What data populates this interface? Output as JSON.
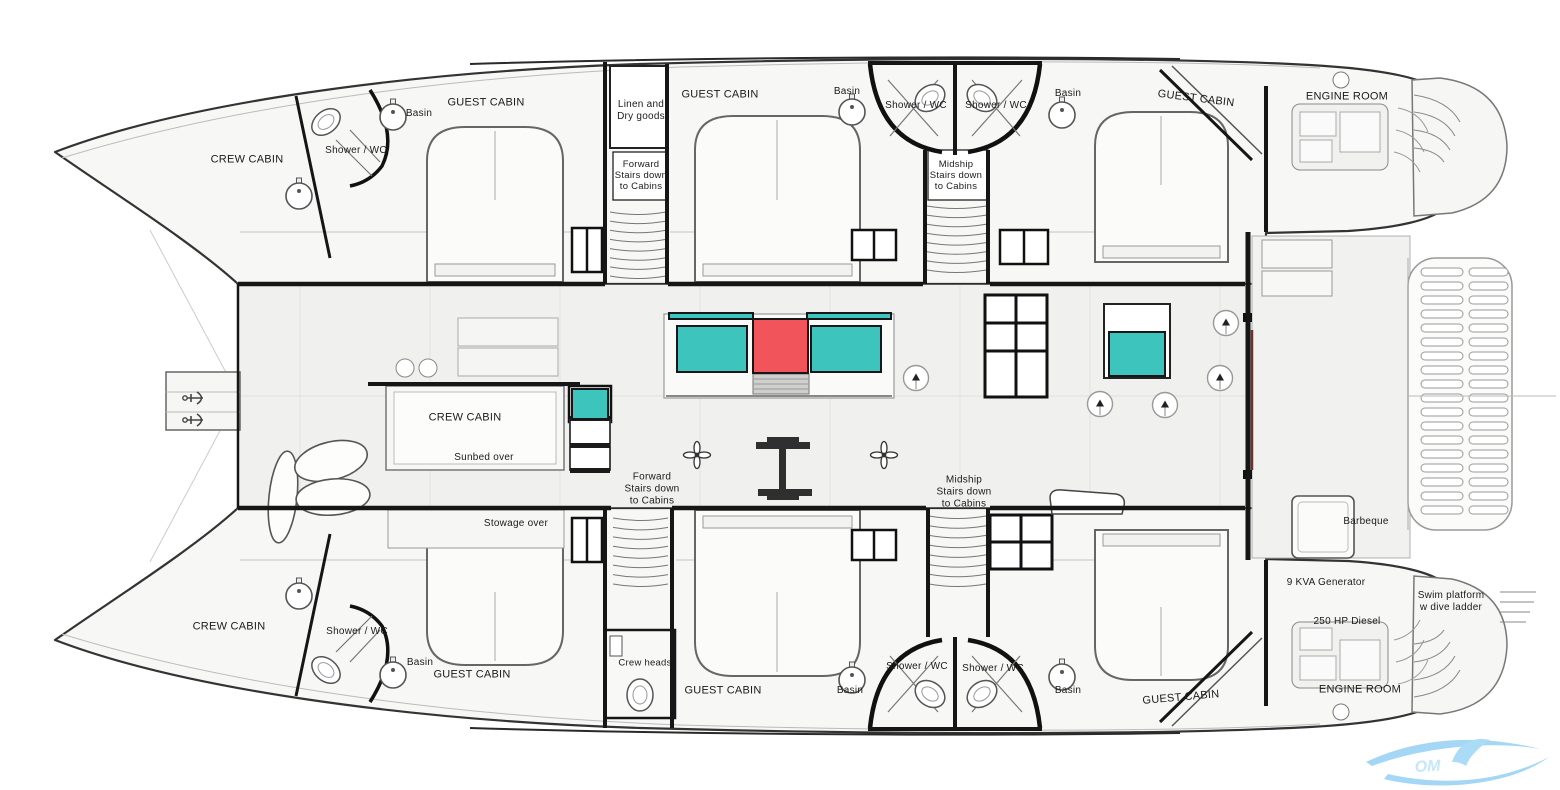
{
  "title": "Catamaran yacht deck floor plan",
  "colors": {
    "teal": "#3cc4bd",
    "red": "#f2545b",
    "wall": "#1b1b1b",
    "watermark_blue": "#9ad2f4",
    "watermark_text": "#c6e6fa",
    "label_color": "#1b1b1b"
  },
  "labels": [
    {
      "id": "crew-cabin-top-left",
      "text": "CREW CABIN",
      "x": 247,
      "y": 160,
      "size": 11
    },
    {
      "id": "shower-wc-top-left",
      "text": "Shower / WC",
      "x": 356,
      "y": 151,
      "size": 10
    },
    {
      "id": "basin-top-left",
      "text": "Basin",
      "x": 419,
      "y": 114,
      "size": 10
    },
    {
      "id": "guest-cabin-top-left",
      "text": "GUEST CABIN",
      "x": 486,
      "y": 103,
      "size": 11
    },
    {
      "id": "linen-dry-goods",
      "text": "Linen and\nDry goods",
      "x": 641,
      "y": 111,
      "size": 10
    },
    {
      "id": "guest-cabin-top-center",
      "text": "GUEST CABIN",
      "x": 720,
      "y": 95,
      "size": 11
    },
    {
      "id": "basin-top-center-left",
      "text": "Basin",
      "x": 847,
      "y": 92,
      "size": 10
    },
    {
      "id": "shower-wc-top-center-left",
      "text": "Shower / WC",
      "x": 916,
      "y": 106,
      "size": 10
    },
    {
      "id": "shower-wc-top-center-right",
      "text": "Shower / WC",
      "x": 996,
      "y": 106,
      "size": 10
    },
    {
      "id": "basin-top-center-right",
      "text": "Basin",
      "x": 1068,
      "y": 94,
      "size": 10
    },
    {
      "id": "forward-stairs-top",
      "text": "Forward\nStairs down\nto Cabins",
      "x": 641,
      "y": 176,
      "size": 9.5
    },
    {
      "id": "midship-stairs-top",
      "text": "Midship\nStairs down\nto Cabins",
      "x": 956,
      "y": 176,
      "size": 9.5
    },
    {
      "id": "guest-cabin-top-right",
      "text": "GUEST CABIN",
      "x": 1196,
      "y": 99,
      "size": 11,
      "rot": 7
    },
    {
      "id": "engine-room-top",
      "text": "ENGINE ROOM",
      "x": 1347,
      "y": 97,
      "size": 11
    },
    {
      "id": "crew-cabin-mid",
      "text": "CREW CABIN",
      "x": 465,
      "y": 418,
      "size": 11
    },
    {
      "id": "sunbed-over",
      "text": "Sunbed over",
      "x": 484,
      "y": 458,
      "size": 10
    },
    {
      "id": "stowage-over",
      "text": "Stowage over",
      "x": 516,
      "y": 524,
      "size": 10
    },
    {
      "id": "forward-stairs-mid",
      "text": "Forward\nStairs down\nto Cabins",
      "x": 652,
      "y": 489,
      "size": 10
    },
    {
      "id": "midship-stairs-mid",
      "text": "Midship\nStairs down\nto Cabins",
      "x": 964,
      "y": 492,
      "size": 10
    },
    {
      "id": "barbeque",
      "text": "Barbeque",
      "x": 1366,
      "y": 522,
      "size": 10
    },
    {
      "id": "generator",
      "text": "9 KVA Generator",
      "x": 1326,
      "y": 583,
      "size": 10
    },
    {
      "id": "swim-platform",
      "text": "Swim platform\nw dive ladder",
      "x": 1451,
      "y": 602,
      "size": 10
    },
    {
      "id": "diesel",
      "text": "250 HP Diesel",
      "x": 1347,
      "y": 622,
      "size": 10
    },
    {
      "id": "engine-room-bottom",
      "text": "ENGINE ROOM",
      "x": 1360,
      "y": 690,
      "size": 11
    },
    {
      "id": "crew-cabin-bottom-left",
      "text": "CREW CABIN",
      "x": 229,
      "y": 627,
      "size": 11
    },
    {
      "id": "shower-wc-bottom-left",
      "text": "Shower / WC",
      "x": 357,
      "y": 632,
      "size": 10
    },
    {
      "id": "basin-bottom-left",
      "text": "Basin",
      "x": 420,
      "y": 663,
      "size": 10
    },
    {
      "id": "guest-cabin-bottom-left",
      "text": "GUEST CABIN",
      "x": 472,
      "y": 675,
      "size": 11
    },
    {
      "id": "crew-heads",
      "text": "Crew heads",
      "x": 645,
      "y": 663,
      "size": 9.5
    },
    {
      "id": "guest-cabin-bottom-center",
      "text": "GUEST CABIN",
      "x": 723,
      "y": 691,
      "size": 11
    },
    {
      "id": "basin-bottom-center-left",
      "text": "Basin",
      "x": 850,
      "y": 691,
      "size": 10
    },
    {
      "id": "shower-wc-bottom-center-left",
      "text": "Shower / WC",
      "x": 917,
      "y": 667,
      "size": 10
    },
    {
      "id": "shower-wc-bottom-center-right",
      "text": "Shower / WC",
      "x": 993,
      "y": 669,
      "size": 10
    },
    {
      "id": "basin-bottom-center-right",
      "text": "Basin",
      "x": 1068,
      "y": 691,
      "size": 10
    },
    {
      "id": "guest-cabin-bottom-right",
      "text": "GUEST CABIN",
      "x": 1181,
      "y": 698,
      "size": 11,
      "rot": -5
    }
  ],
  "colored_elements": [
    {
      "id": "galley-counter-lid-left",
      "x": 668,
      "y": 312,
      "w": 86,
      "h": 8,
      "color": "teal"
    },
    {
      "id": "galley-counter-lid-right",
      "x": 806,
      "y": 312,
      "w": 86,
      "h": 8,
      "color": "teal"
    },
    {
      "id": "galley-counter-left",
      "x": 676,
      "y": 325,
      "w": 72,
      "h": 48,
      "color": "teal"
    },
    {
      "id": "galley-counter-center",
      "x": 752,
      "y": 318,
      "w": 57,
      "h": 56,
      "color": "red"
    },
    {
      "id": "galley-counter-right",
      "x": 810,
      "y": 325,
      "w": 72,
      "h": 48,
      "color": "teal"
    },
    {
      "id": "saloon-cabinet-teal",
      "x": 1108,
      "y": 331,
      "w": 58,
      "h": 46,
      "color": "teal"
    },
    {
      "id": "dumbwaiter-teal",
      "x": 571,
      "y": 388,
      "w": 38,
      "h": 32,
      "color": "teal"
    }
  ],
  "watermark": {
    "letters": "OM"
  }
}
